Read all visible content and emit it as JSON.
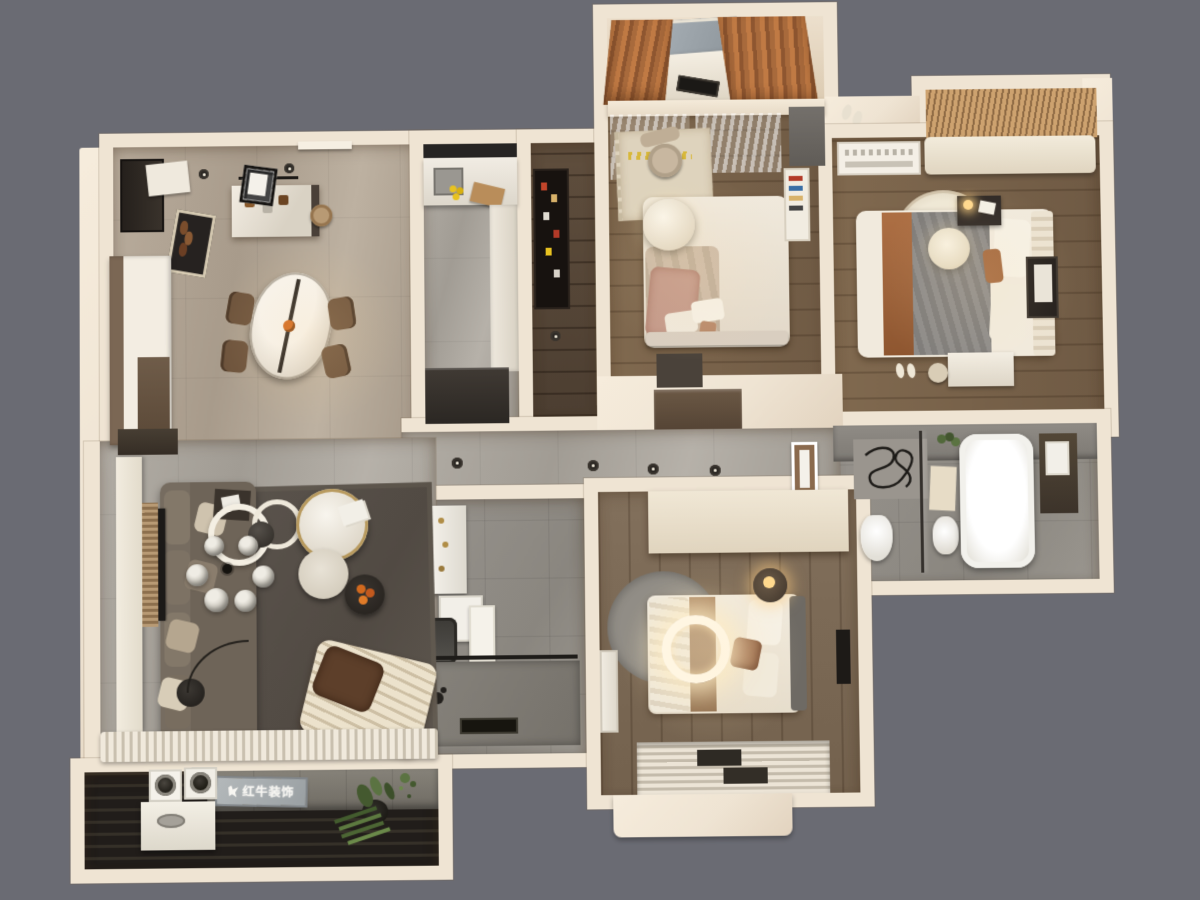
{
  "scene": {
    "type": "3d-floorplan-render",
    "view": "top-down dollhouse",
    "background_color": "#6a6b73",
    "wall_color": "#efe4d3",
    "accent_colors": {
      "rust_curtain": "#a86a3c",
      "dark_wood": "#5f4e3d",
      "gray_marble": "#a5a099",
      "warm_light": "#ffdfae"
    }
  },
  "watermark": {
    "text": "红牛装饰",
    "logo": "bull-icon",
    "plaque_color": "#a8adb0"
  },
  "rooms": [
    {
      "id": "dining-entry",
      "name": "dining-entry",
      "furniture": [
        "entry-door",
        "shoe-cabinet",
        "doormat-with-shoes",
        "entry-console",
        "bar-island",
        "bar-stool",
        "menu-board",
        "oval-marble-dining-table",
        "dining-chairs-x4",
        "ceiling-spotlights"
      ]
    },
    {
      "id": "kitchen",
      "name": "kitchen",
      "furniture": [
        "sink",
        "faucet",
        "lemons",
        "cutting-board",
        "u-shaped-counter",
        "refrigerator",
        "backsplash-cabinets"
      ]
    },
    {
      "id": "hallway",
      "name": "hallway",
      "furniture": [
        "wine-display-cabinet"
      ]
    },
    {
      "id": "bedroom-top",
      "name": "bedroom-secondary-top",
      "furniture": [
        "balcony-study-desk",
        "laptop",
        "rust-curtains",
        "sheer-curtains",
        "area-rug",
        "desk-chair",
        "double-bed",
        "round-pendant-lamp",
        "wall-shelf",
        "gray-desk",
        "wardrobe"
      ]
    },
    {
      "id": "bedroom-master",
      "name": "bedroom-master",
      "furniture": [
        "window-seat",
        "wood-blinds",
        "ac-unit",
        "double-bed-gray-rust",
        "ribbed-headboard",
        "round-cream-rug",
        "rattan-pendant",
        "nightstand-with-lamp",
        "tv-panel",
        "dresser",
        "stool",
        "slippers"
      ]
    },
    {
      "id": "bath-master",
      "name": "bathroom-master",
      "furniture": [
        "bathtub",
        "toilet",
        "basin",
        "glass-shower-partition",
        "squiggle-wall-art",
        "bath-mat",
        "dark-storage-panel",
        "towel"
      ]
    },
    {
      "id": "bath-second",
      "name": "bathroom-second",
      "furniture": [
        "vanity-counter",
        "gold-fixtures",
        "storage-cabinet",
        "toilet",
        "hanging-towel",
        "walk-in-shower",
        "floor-drain",
        "shower-head"
      ]
    },
    {
      "id": "bedroom-bottom",
      "name": "bedroom-bottom",
      "furniture": [
        "full-width-wardrobe",
        "double-bed-tan-stripe",
        "glowing-ring-ceiling-light",
        "round-gray-rug",
        "round-nightstand-lamp",
        "ac-unit",
        "bay-window-pleated-curtains",
        "tv-panel"
      ]
    },
    {
      "id": "living",
      "name": "living-room",
      "furniture": [
        "l-shaped-sofa",
        "throw-pillows",
        "glass-globe-chandelier",
        "round-marble-coffee-tables",
        "dark-side-table-with-fruit",
        "dark-area-rug",
        "tv-console",
        "wood-slat-tv-panel",
        "flat-tv",
        "tall-storage-cabinets",
        "floor-lamp",
        "striped-daybed-with-throw",
        "window-curtain-band"
      ]
    },
    {
      "id": "balcony-laundry",
      "name": "balcony-laundry",
      "furniture": [
        "washer",
        "dryer",
        "laundry-sink-cabinet",
        "brand-plaque",
        "potted-plants",
        "hanging-plant",
        "dark-slatted-floor"
      ]
    },
    {
      "id": "corridor",
      "name": "corridor",
      "furniture": [
        "recessed-ceiling-lights",
        "framed-art",
        "built-in-closet"
      ]
    }
  ]
}
